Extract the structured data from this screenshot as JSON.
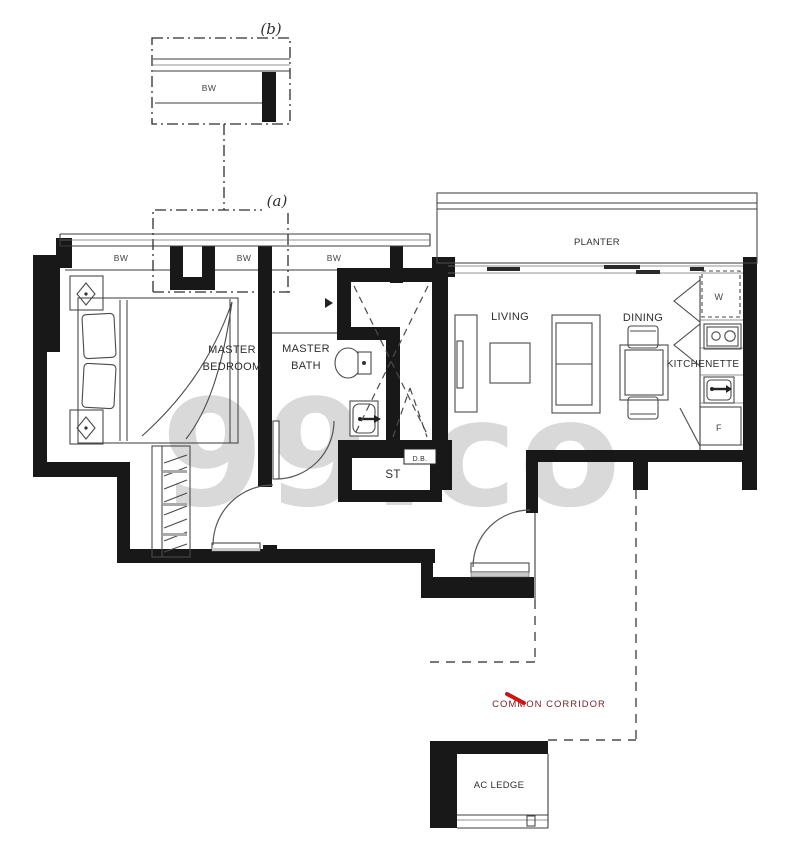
{
  "watermark": "99.co",
  "detail": {
    "b_tag": "(b)",
    "a_tag": "(a)",
    "bw": "BW"
  },
  "rooms": {
    "master_bedroom_l1": "MASTER",
    "master_bedroom_l2": "BEDROOM",
    "master_bath_l1": "MASTER",
    "master_bath_l2": "BATH",
    "living": "LIVING",
    "dining": "DINING",
    "kitchenette": "KITCHENETTE",
    "planter": "PLANTER",
    "store": "ST",
    "db": "D.B.",
    "washer": "W",
    "fridge": "F",
    "common_corridor": "COMMON CORRIDOR",
    "ac_ledge": "AC LEDGE"
  },
  "colors": {
    "wall": "#181818",
    "plan_line": "#3c3c3c",
    "corridor_text": "#7a2424",
    "corridor_slash": "#cc1414",
    "watermark": "#d9d9d9"
  }
}
